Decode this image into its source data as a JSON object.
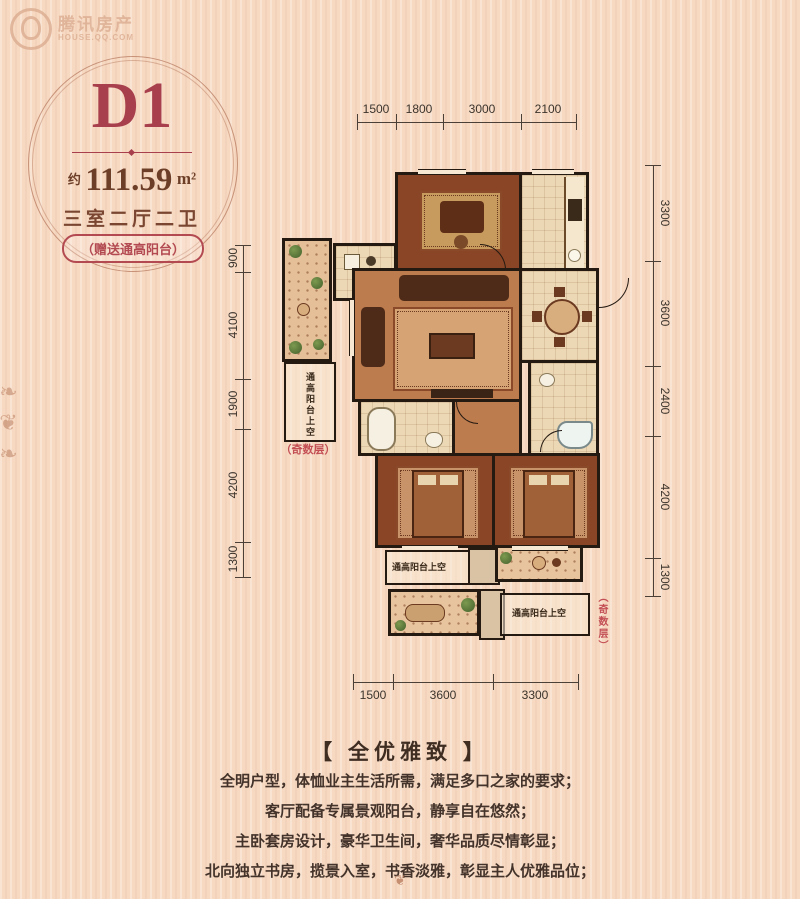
{
  "watermark": {
    "brand": "腾讯房产",
    "url": "HOUSE.QQ.COM"
  },
  "unit_badge": {
    "code": "D1",
    "area_prefix": "约",
    "area_value": "111.59",
    "area_unit": "m²",
    "layout": "三室二厅二卫",
    "bonus": "（赠送通高阳台）"
  },
  "dimensions": {
    "top": [
      "1500",
      "1800",
      "3000",
      "2100"
    ],
    "right": [
      "3300",
      "3600",
      "2400",
      "4200",
      "1300"
    ],
    "left": [
      "900",
      "4100",
      "1900",
      "4200",
      "1300"
    ],
    "bottom": [
      "1500",
      "3600",
      "3300"
    ]
  },
  "plan_labels": {
    "left_balcony_void": "通高阳台上空",
    "left_floor_note": "（奇数层）",
    "bottom_left_void": "通高阳台上空",
    "bottom_right_void": "通高阳台上空",
    "right_floor_note": "（奇数层）"
  },
  "description": {
    "title": "【 全优雅致 】",
    "lines": [
      "全明户型，体恤业主生活所需，满足多口之家的要求；",
      "客厅配备专属景观阳台，静享自在悠然；",
      "主卧套房设计，豪华卫生间，奢华品质尽情彰显；",
      "北向独立书房，揽景入室，书香淡雅，彰显主人优雅品位；"
    ]
  },
  "icons": {
    "flourish_left": "❧❦❧",
    "flourish_bottom": "❦"
  },
  "colors": {
    "badge_red": "#a83f4c",
    "text_brown": "#6e3f28",
    "note_red": "#c34f55",
    "wall": "#241a12",
    "background": "#f7d9c2"
  }
}
